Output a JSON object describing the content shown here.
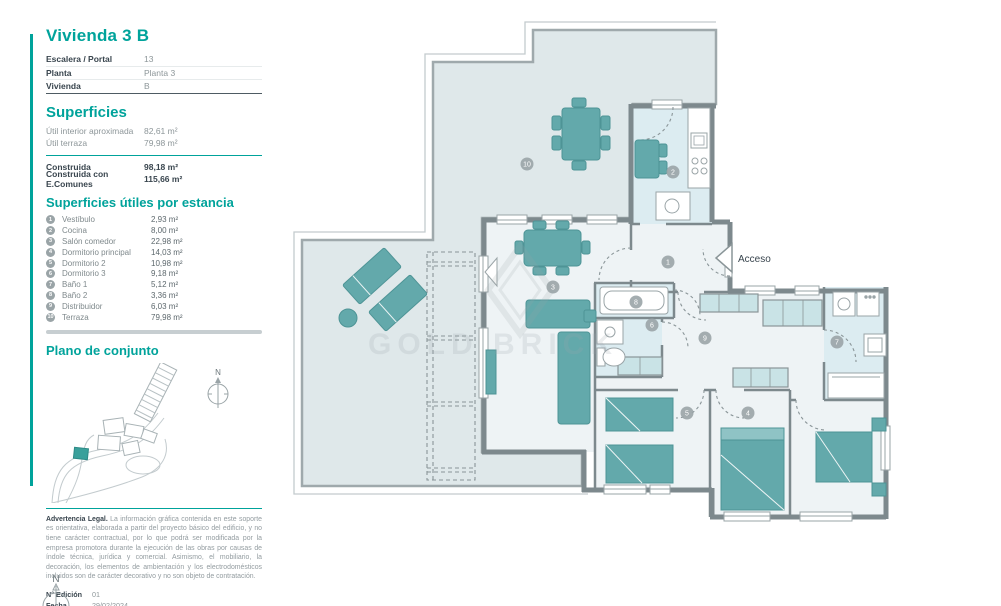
{
  "sidebar": {
    "title": "Vivienda 3 B",
    "info_rows": [
      {
        "label": "Escalera / Portal",
        "value": "13"
      },
      {
        "label": "Planta",
        "value": "Planta 3"
      },
      {
        "label": "Vivienda",
        "value": "B"
      }
    ],
    "superficies": {
      "heading": "Superficies",
      "rows": [
        {
          "label": "Útil interior aproximada",
          "value": "82,61 m²",
          "bold": false
        },
        {
          "label": "Útil terraza",
          "value": "79,98 m²",
          "bold": false
        },
        {
          "label": "Construida",
          "value": "98,18 m²",
          "bold": true
        },
        {
          "label": "Construida con E.Comunes",
          "value": "115,66 m²",
          "bold": true
        }
      ]
    },
    "estancias": {
      "heading": "Superficies útiles por estancia",
      "rows": [
        {
          "num": "1",
          "label": "Vestíbulo",
          "value": "2,93 m²"
        },
        {
          "num": "2",
          "label": "Cocina",
          "value": "8,00 m²"
        },
        {
          "num": "3",
          "label": "Salón comedor",
          "value": "22,98 m²"
        },
        {
          "num": "4",
          "label": "Dormitorio principal",
          "value": "14,03 m²"
        },
        {
          "num": "5",
          "label": "Dormitorio 2",
          "value": "10,98 m²"
        },
        {
          "num": "6",
          "label": "Dormitorio 3",
          "value": "9,18 m²"
        },
        {
          "num": "7",
          "label": "Baño 1",
          "value": "5,12 m²"
        },
        {
          "num": "8",
          "label": "Baño 2",
          "value": "3,36 m²"
        },
        {
          "num": "9",
          "label": "Distribuidor",
          "value": "6,03 m²"
        },
        {
          "num": "10",
          "label": "Terraza",
          "value": "79,98 m²"
        }
      ]
    },
    "plano_heading": "Plano de conjunto",
    "legal": {
      "bold_intro": "Advertencia Legal.",
      "text": " La información gráfica contenida en este soporte es orientativa, elaborada a partir del proyecto básico del edificio, y no tiene carácter contractual, por lo que podrá ser modificada por la empresa promotora durante la ejecución de las obras por causas de índole técnica, jurídica y comercial. Asimismo, el mobiliario, la decoración, los elementos de ambientación y los electrodomésticos incluidos son de carácter decorativo y no son objeto de contratación.",
      "edition_label": "N° Edición",
      "edition_value": "01",
      "date_label": "Fecha",
      "date_value": "29/02/2024"
    }
  },
  "plan": {
    "acceso_label": "Acceso",
    "watermark": "GOLD BRICK",
    "north_letter": "N",
    "room_markers": [
      {
        "num": "10",
        "x": 527,
        "y": 164
      },
      {
        "num": "2",
        "x": 673,
        "y": 172
      },
      {
        "num": "1",
        "x": 668,
        "y": 262
      },
      {
        "num": "3",
        "x": 553,
        "y": 287
      },
      {
        "num": "8",
        "x": 636,
        "y": 302
      },
      {
        "num": "6",
        "x": 652,
        "y": 325
      },
      {
        "num": "9",
        "x": 705,
        "y": 338
      },
      {
        "num": "7",
        "x": 837,
        "y": 342
      },
      {
        "num": "5",
        "x": 687,
        "y": 413
      },
      {
        "num": "4",
        "x": 748,
        "y": 413
      }
    ]
  },
  "colors": {
    "accent": "#00a39b",
    "furniture": "#63a9ab",
    "wall": "#7d898d",
    "marker": "#9aa4a7",
    "terrace_fill": "#dfe8ea",
    "wet_fill": "#dcecf1",
    "room_fill": "#eef3f5"
  }
}
